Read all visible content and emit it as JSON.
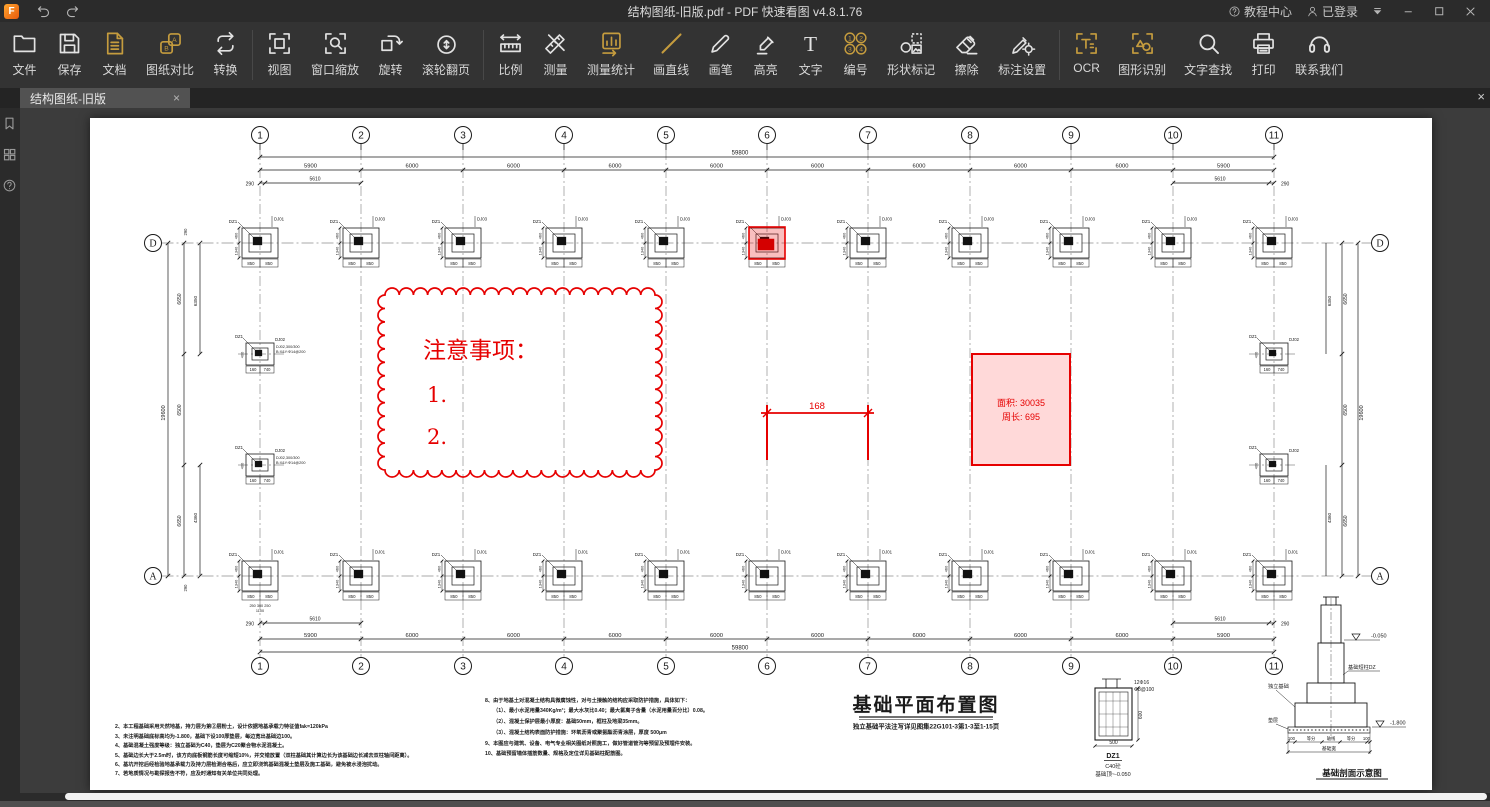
{
  "window": {
    "title": "结构图纸-旧版.pdf - PDF 快速看图 v4.8.1.76"
  },
  "titlebar": {
    "logo": "F",
    "tutorial": "教程中心",
    "login": "已登录"
  },
  "glyphs": {
    "close": "×"
  },
  "tab": {
    "label": "结构图纸-旧版"
  },
  "colors": {
    "gold": "#C59C3E",
    "red": "#E60000",
    "pink_fill": "#FFD9D9"
  },
  "toolbar": {
    "groups": [
      {
        "items": [
          {
            "label": "文件",
            "icon": "folder"
          },
          {
            "label": "保存",
            "icon": "save"
          },
          {
            "label": "文档",
            "icon": "doc",
            "accent": true
          },
          {
            "label": "图纸对比",
            "icon": "compare",
            "accent": true
          },
          {
            "label": "转换",
            "icon": "convert"
          }
        ]
      },
      {
        "items": [
          {
            "label": "视图",
            "icon": "view"
          },
          {
            "label": "窗口缩放",
            "icon": "winzoom"
          },
          {
            "label": "旋转",
            "icon": "rotate"
          },
          {
            "label": "滚轮翻页",
            "icon": "scroll"
          }
        ]
      },
      {
        "items": [
          {
            "label": "比例",
            "icon": "scale"
          },
          {
            "label": "测量",
            "icon": "measure"
          },
          {
            "label": "测量统计",
            "icon": "stats",
            "accent": true
          },
          {
            "label": "画直线",
            "icon": "lineicon",
            "accent": true
          },
          {
            "label": "画笔",
            "icon": "pen"
          },
          {
            "label": "高亮",
            "icon": "highlight"
          },
          {
            "label": "文字",
            "icon": "textt"
          },
          {
            "label": "编号",
            "icon": "numbers",
            "accent": true
          },
          {
            "label": "形状标记",
            "icon": "shapes"
          },
          {
            "label": "擦除",
            "icon": "eraser"
          },
          {
            "label": "标注设置",
            "icon": "annoset"
          }
        ]
      },
      {
        "items": [
          {
            "label": "OCR",
            "icon": "ocr",
            "accent": true
          },
          {
            "label": "图形识别",
            "icon": "shaperec",
            "accent": true
          },
          {
            "label": "文字查找",
            "icon": "search"
          },
          {
            "label": "打印",
            "icon": "print"
          },
          {
            "label": "联系我们",
            "icon": "contact"
          }
        ]
      }
    ]
  },
  "drawing": {
    "columns": [
      "1",
      "2",
      "3",
      "4",
      "5",
      "6",
      "7",
      "8",
      "9",
      "10",
      "11"
    ],
    "row_labels": [
      "D",
      "A"
    ],
    "bays": [
      "5900",
      "6000",
      "6000",
      "6000",
      "6000",
      "6000",
      "6000",
      "6000",
      "6000",
      "5900"
    ],
    "overall": "59800",
    "sub_left": [
      "290",
      "5610"
    ],
    "sub_right": [
      "5610",
      "290"
    ],
    "v_overall": "19600",
    "v_segs": [
      "6650",
      "6500",
      "6650"
    ],
    "v_inner_top": "6350",
    "v_inner_bottom": "4360",
    "v_edge": "290",
    "footing": {
      "col": "DZ1",
      "top_first": "DJ01",
      "top": "DJ03",
      "bottom": "DJ01",
      "side_top": "460",
      "side_bottom": "1340",
      "bot_dims": [
        "850",
        "850"
      ]
    },
    "footing_mid": {
      "col": "DZ1",
      "label": "DJ02",
      "bot_dims": [
        "160",
        "740"
      ],
      "side": "400",
      "extra1": "DJ02,300/300",
      "extra2": "B:X&Y:Φ14@200"
    },
    "col1_extra": [
      "250 300 250",
      "1100"
    ],
    "red": {
      "cloud_title": "注意事项：",
      "item1": "1.",
      "item2": "2.",
      "measure": "168",
      "area": "面积: 30035",
      "perim": "周长: 695"
    },
    "title": "基础平面布置图",
    "subtitle": "独立基础平法注写详见图集22G101-3第1-3至1-15页",
    "dz1": {
      "l1": "12Φ16",
      "l2": "Φ8@100",
      "w": "500",
      "h": "600",
      "name": "DZ1",
      "mat": "C40砼",
      "lvl": "基础顶~-0.050"
    },
    "section": {
      "title": "基础剖面示意图",
      "lvl_top": "-0.050",
      "lvl_bot": "-1.800",
      "pier": "基础短柱DZ",
      "foot": "独立基础",
      "pad": "垫层",
      "dims": [
        "100",
        "等分",
        "轴线",
        "等分",
        "100"
      ],
      "wlabel": "基础宽"
    },
    "notes_left": [
      "2、本工程基础采用天然地基，持力层为第②层粉土，设计依据地基承载力特征值fak=120kPa",
      "3、未注明基础底标高均为-1.800，基础下设100厚垫层，每边宽出基础边100。",
      "4、基础混凝土强度等级：独立基础为C40，垫层为C20聚合物水泥混凝土。",
      "5、基础边长大于2.5m时，该方向底板钢筋长度可缩短10%，并交错放置（双柱基础其计算边长为该基础边长减去双柱轴间距离）。",
      "6、基坑开挖后经检验地基承载力及持力层检测合格后，应立即浇筑基础混凝土垫层及施工基础，避免被水浸泡扰动。",
      "7、若地质情况与勘探报告不符，应及时通知有关单位共同处理。"
    ],
    "notes_right": [
      "8、由于地基土对混凝土结构具微腐蚀性，对与土接触的结构应采取防护措施，具体如下：",
      "（1）、最小水泥用量340Kg/m³；最大水灰比0.40；最大氯离子含量（水泥用量百分比）0.08。",
      "（2）、混凝土保护层最小厚度：基础50mm，框柱及地梁35mm。",
      "（3）、混凝土结构表面防护措施：环氧沥青或聚氨酯沥青涂层，厚度 500μm",
      "9、本图应与建筑、设备、电气专业相关图纸对照施工，做好管道管沟等预留及预埋件安装。",
      "10、基础预留墙体插筋数量、规格及定位详见基础柱配筋图。"
    ]
  }
}
